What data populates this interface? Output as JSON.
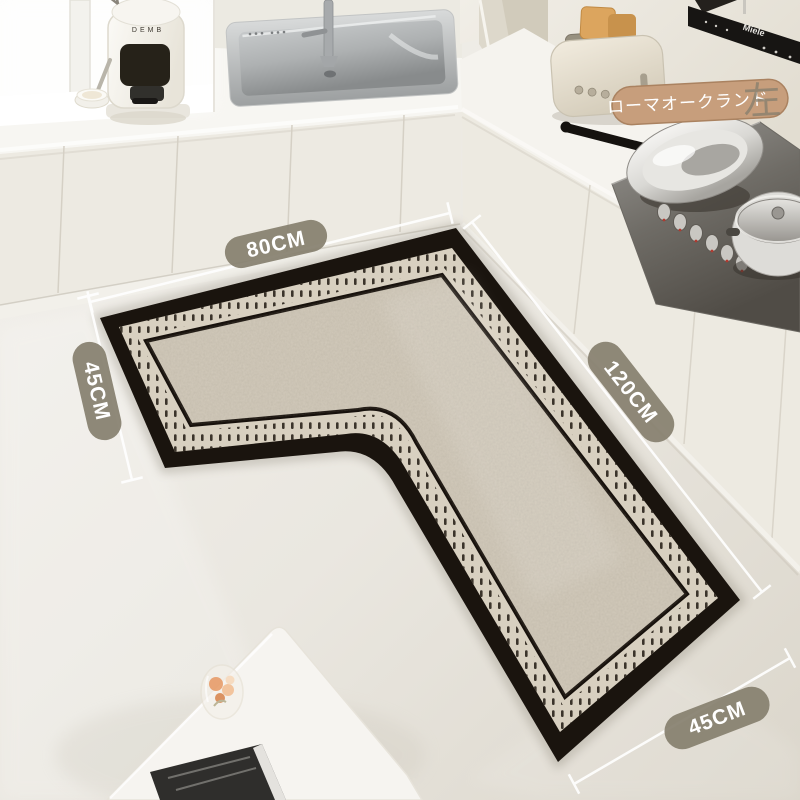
{
  "scene_title": "L-shaped kitchen floor mat product photo",
  "measurements": {
    "top": "80CM",
    "left": "45CM",
    "right": "120CM",
    "bottom": "45CM",
    "pill_color": "#87806f",
    "line_color": "#ffffff"
  },
  "product_tag": {
    "text": "ローマオークランド",
    "side": "左",
    "bg_color": "#c79e7c"
  },
  "appliances": {
    "hood_brand": "Miele",
    "coffee_brand": "DEMB"
  },
  "rug_colors": {
    "outer_border": "#1a140e",
    "dash_band": "#d8d0c0",
    "dashes": "#2a231b",
    "field": "#d2cabb"
  }
}
